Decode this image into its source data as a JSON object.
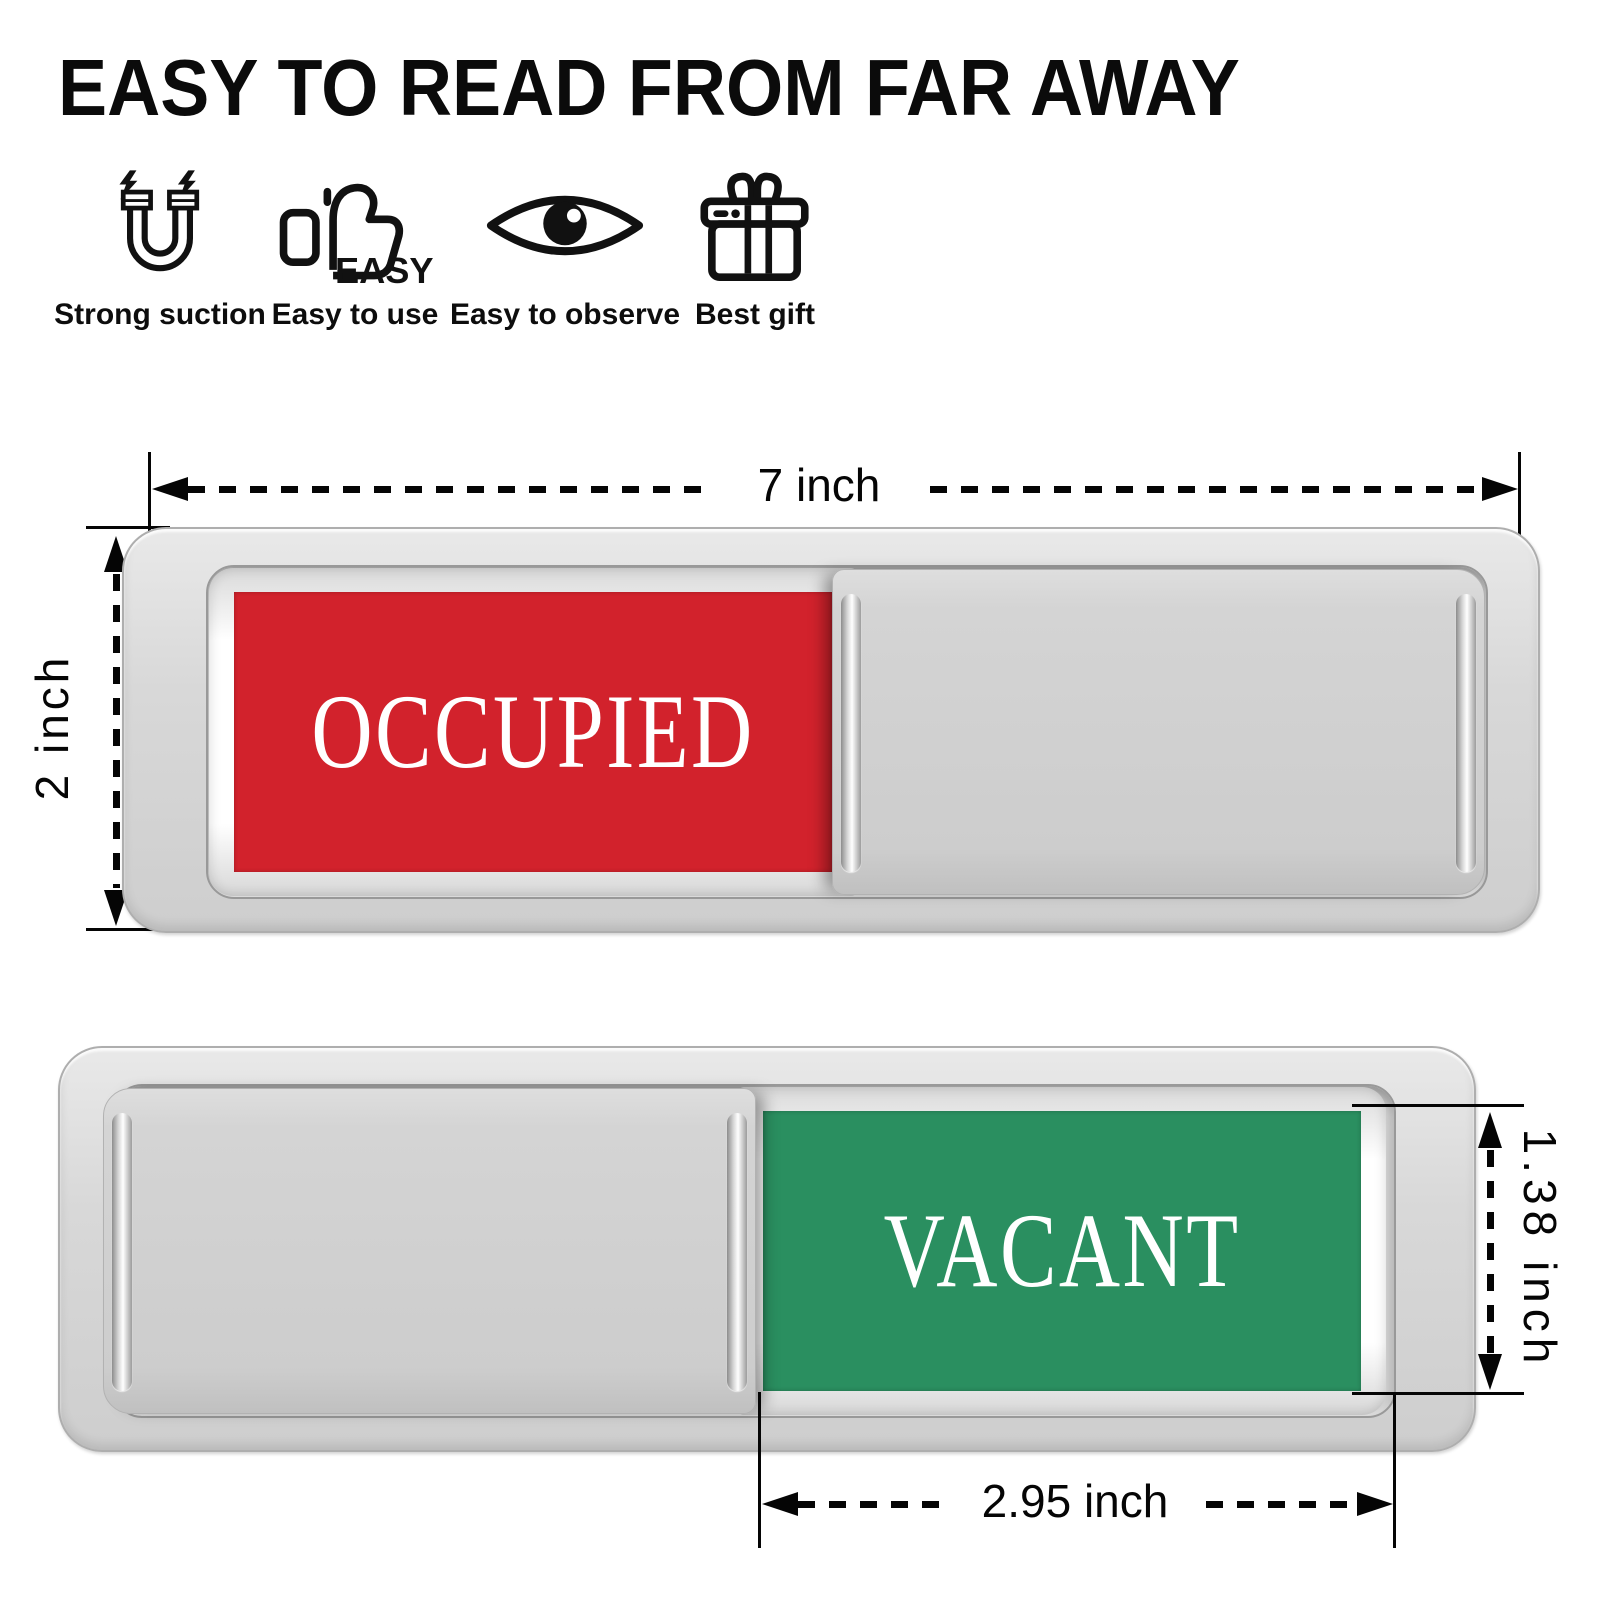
{
  "title": "EASY TO READ FROM FAR AWAY",
  "features": [
    {
      "icon": "magnet-icon",
      "label": "Strong suction"
    },
    {
      "icon": "thumbs-up-easy-icon",
      "label": "Easy to use",
      "icon_text": "EASY"
    },
    {
      "icon": "eye-icon",
      "label": "Easy to observe"
    },
    {
      "icon": "gift-icon",
      "label": "Best gift"
    }
  ],
  "signs": {
    "occupied": {
      "label": "OCCUPIED",
      "panel_color": "#d2222c",
      "text_color": "#ffffff",
      "cover_side": "right"
    },
    "vacant": {
      "label": "VACANT",
      "panel_color": "#2a8f60",
      "text_color": "#ffffff",
      "cover_side": "left"
    }
  },
  "dimensions": {
    "sign_width": "7 inch",
    "sign_height": "2 inch",
    "window_height": "1.38 inch",
    "window_width": "2.95 inch"
  },
  "colors": {
    "body_silver": "#d6d6d6",
    "occupied_red": "#d2222c",
    "vacant_green": "#2a8f60",
    "annotation_black": "#050505"
  }
}
